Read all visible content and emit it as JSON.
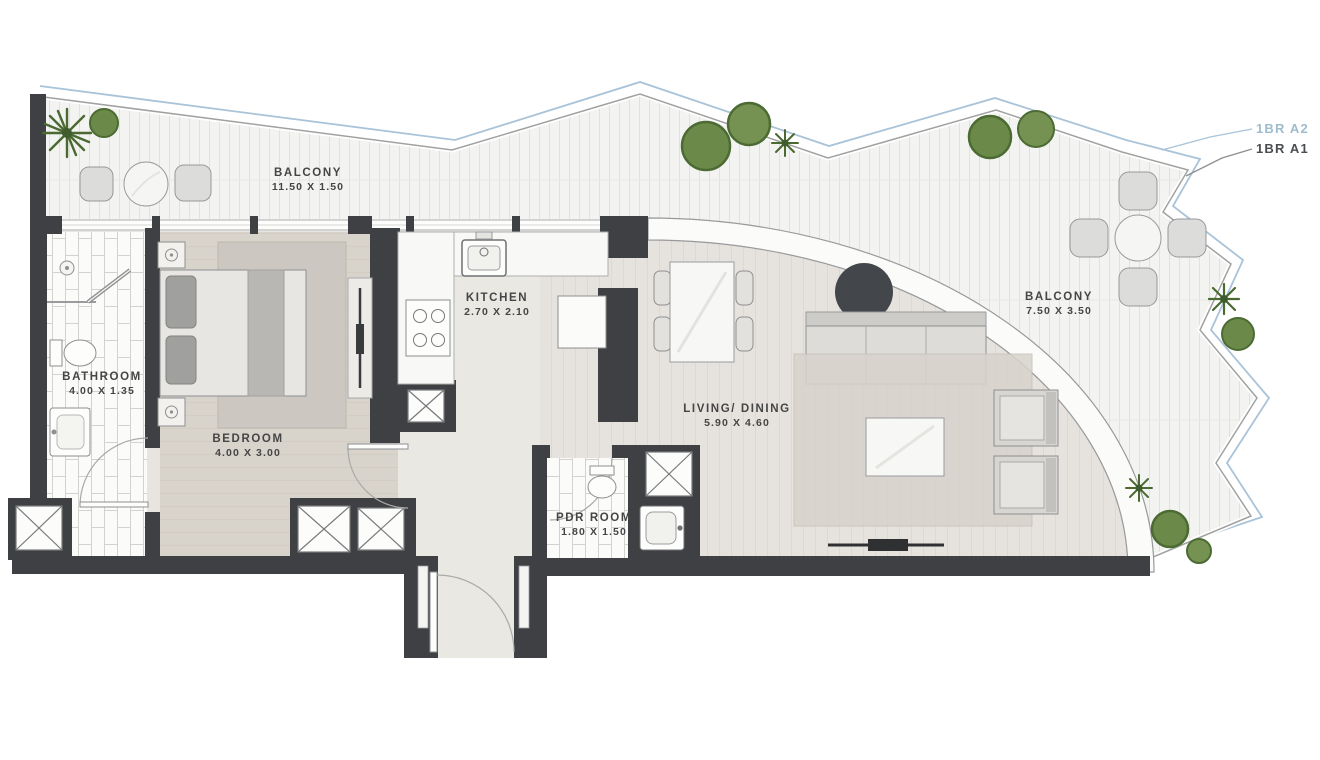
{
  "plan": {
    "variants": [
      {
        "label": "1BR A2",
        "color": "#9fbccf"
      },
      {
        "label": "1BR A1",
        "color": "#4b4e50"
      }
    ],
    "rooms": [
      {
        "id": "balcony-top",
        "name": "BALCONY",
        "dims": "11.50 X 1.50"
      },
      {
        "id": "bathroom",
        "name": "BATHROOM",
        "dims": "4.00 X 1.35"
      },
      {
        "id": "bedroom",
        "name": "BEDROOM",
        "dims": "4.00 X 3.00"
      },
      {
        "id": "kitchen",
        "name": "KITCHEN",
        "dims": "2.70 X 2.10"
      },
      {
        "id": "living-dining",
        "name": "LIVING/ DINING",
        "dims": "5.90 X 4.60"
      },
      {
        "id": "pdr-room",
        "name": "PDR ROOM",
        "dims": "1.80 X 1.50"
      },
      {
        "id": "balcony-right",
        "name": "BALCONY",
        "dims": "7.50 X 3.50"
      }
    ],
    "colors": {
      "wall": "#3f4043",
      "variant_a2_accent": "#a9c3d8",
      "deck": "#f3f3f1",
      "plant_green": "#6b8a4a",
      "label_text": "#454545"
    }
  }
}
